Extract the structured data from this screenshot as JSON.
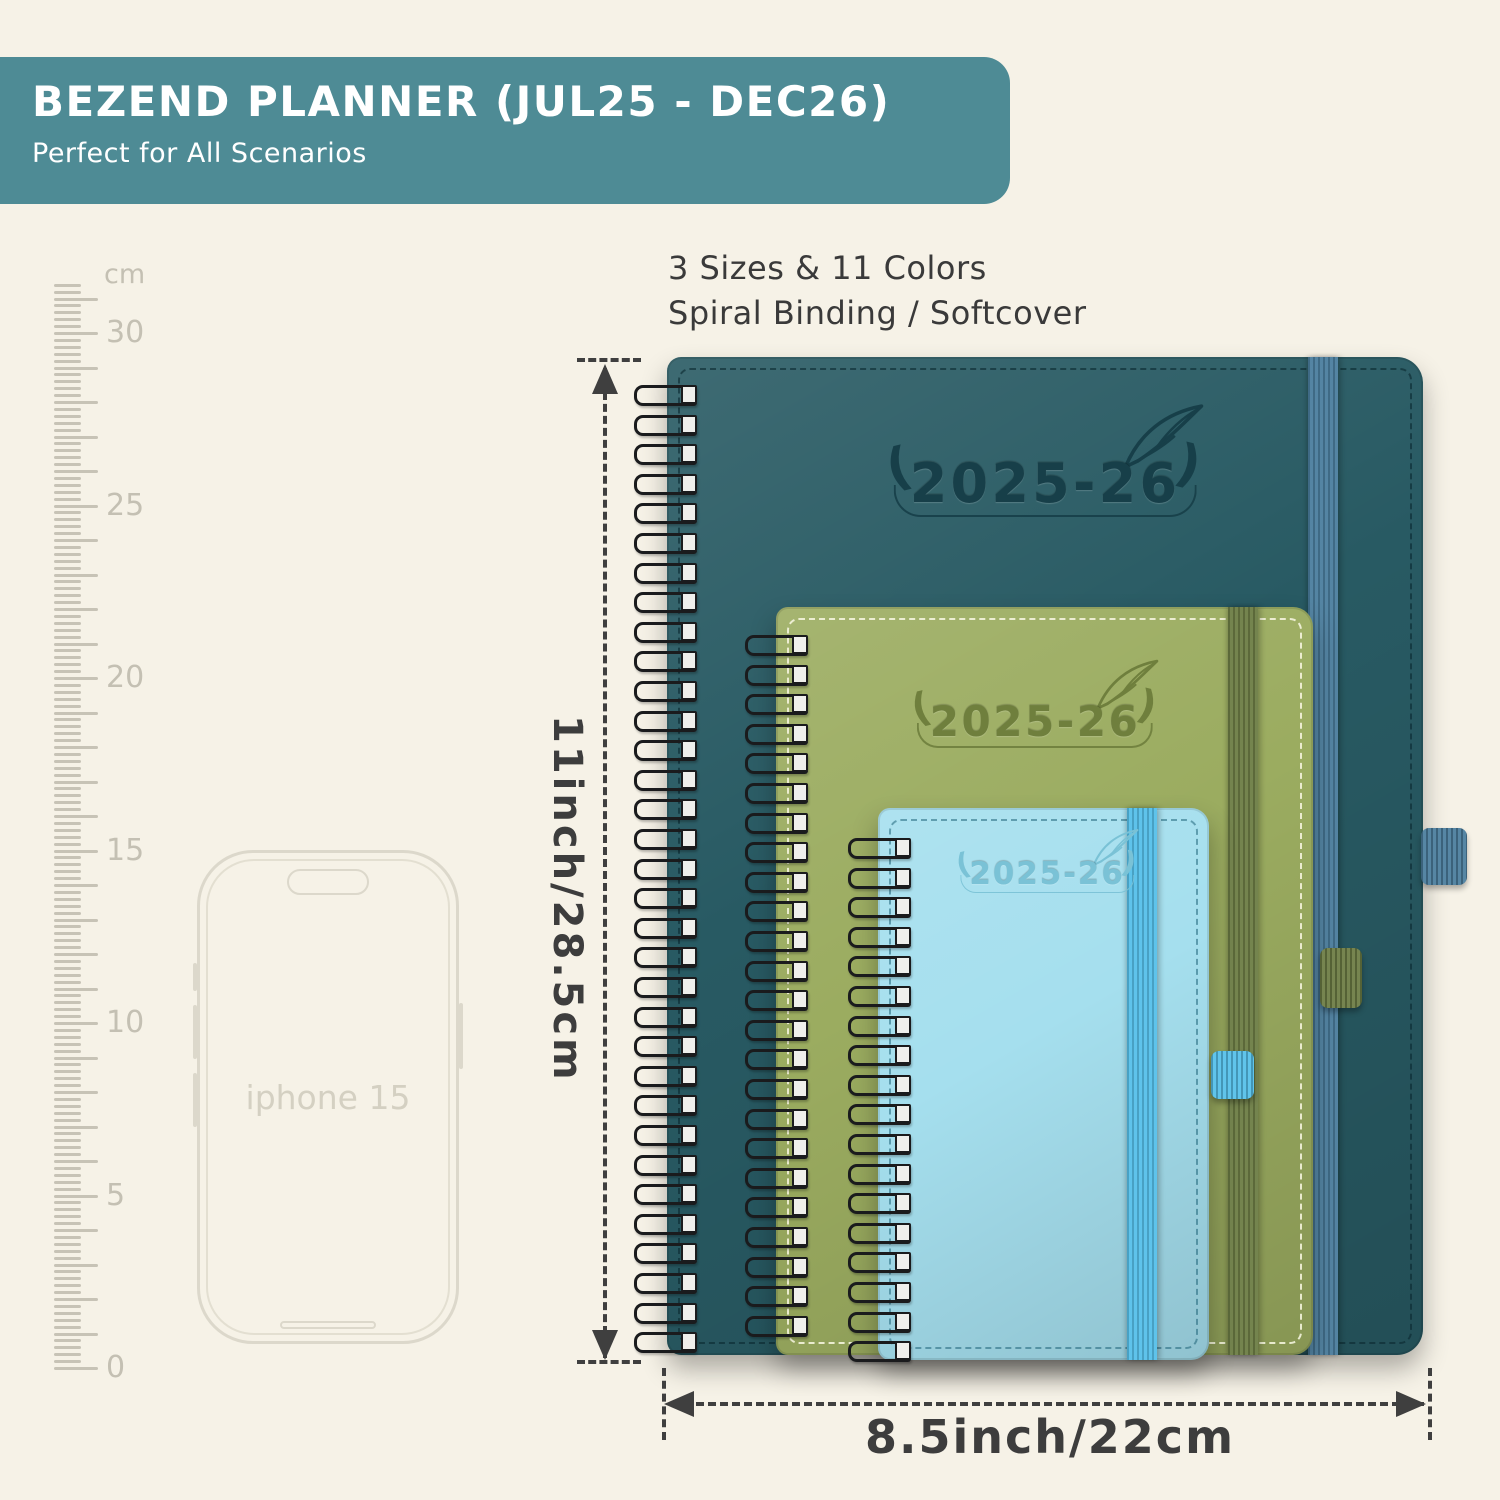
{
  "banner": {
    "title": "BEZEND PLANNER (JUL25 - DEC26)",
    "subtitle": "Perfect for All Scenarios",
    "bg_color": "#4e8b95",
    "text_color": "#ffffff"
  },
  "info": {
    "line1": "3 Sizes & 11 Colors",
    "line2": "Spiral Binding / Softcover"
  },
  "ruler": {
    "unit": "cm",
    "major_labels": [
      "0",
      "5",
      "10",
      "15",
      "20",
      "25",
      "30"
    ]
  },
  "phone": {
    "label": "iphone 15"
  },
  "planners": [
    {
      "size": "large",
      "label": "2025-26",
      "cover_color": "#285a63",
      "band_color": "#4b7e9e",
      "stitch_color": "rgba(10,40,48,0.60)",
      "emboss_color": "#173f49"
    },
    {
      "size": "medium",
      "label": "2025-26",
      "cover_color": "#9bac60",
      "band_color": "#6d7d45",
      "stitch_color": "rgba(250,248,228,0.85)",
      "emboss_color": "#6f7f3d"
    },
    {
      "size": "small",
      "label": "2025-26",
      "cover_color": "#a5dfee",
      "band_color": "#56c0ea",
      "stitch_color": "rgba(20,90,112,0.50)",
      "emboss_color": "#7ac2d6"
    }
  ],
  "dimensions": {
    "height_label": "11inch/28.5cm",
    "width_label": "8.5inch/22cm"
  },
  "background_color": "#f6f2e7",
  "annotation_color": "#3d3d3d"
}
